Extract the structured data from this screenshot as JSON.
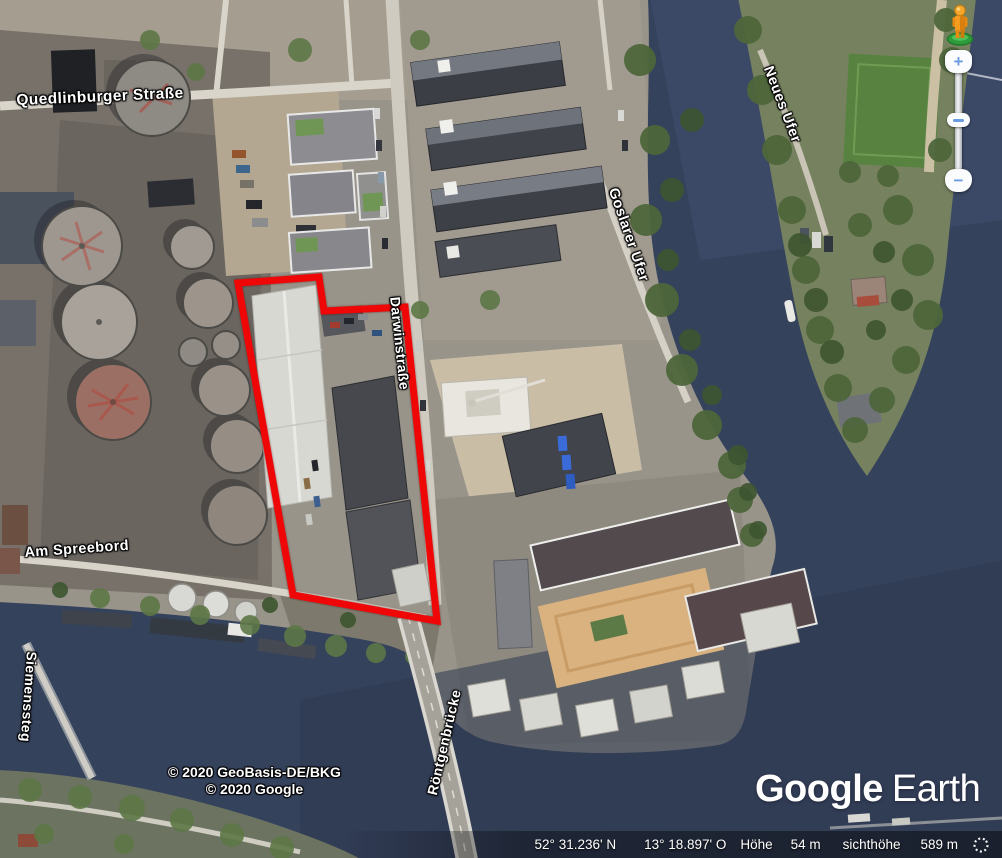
{
  "map": {
    "street_labels": {
      "quedlinburger": "Quedlinburger Straße",
      "darwinstrasse": "Darwinstraße",
      "goslarer_ufer": "Goslarer Ufer",
      "neues_ufer": "Neues Ufer",
      "am_spreebord": "Am Spreebord",
      "siemenssteg": "Siemenssteg",
      "roentgenbruecke": "Röntgenbrücke"
    },
    "attribution": {
      "line1": "© 2020 GeoBasis-DE/BKG",
      "line2": "© 2020 Google"
    },
    "highlight_polygon": {
      "color": "#ef0708",
      "points": "238,283 319,277 324,311 405,307 437,621 293,595"
    }
  },
  "logo": {
    "google": "Google",
    "earth": "Earth"
  },
  "status_bar": {
    "latitude": "52° 31.236' N",
    "longitude": "13° 18.897' O",
    "altitude_label": "Höhe",
    "altitude_value": "54 m",
    "eye_altitude_label": "sichthöhe",
    "eye_altitude_value": "589 m"
  },
  "controls": {
    "pegman_icon": "pegman-icon",
    "zoom_in": "+",
    "zoom_out": "−"
  },
  "colors": {
    "water": "#35425c",
    "land": "#98948a",
    "vegetation": "#4e663b",
    "highlight": "#ef0708",
    "control_accent": "#6b9be0"
  }
}
